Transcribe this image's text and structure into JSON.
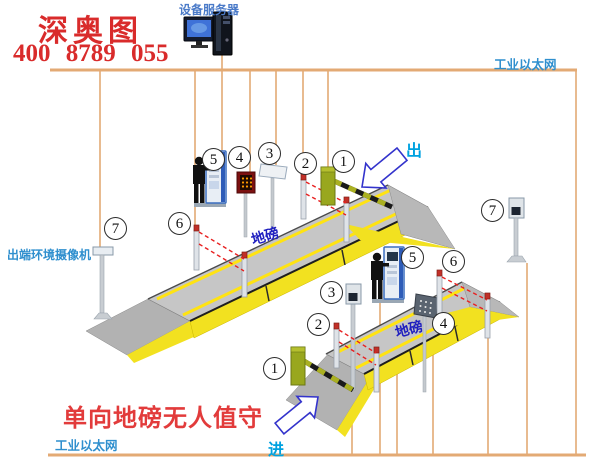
{
  "title": {
    "brand": "深奥图",
    "phone": "400 8789 055"
  },
  "network": {
    "server_label": "设备服务器",
    "ethernet_top": "工业以太网",
    "ethernet_bottom": "工业以太网"
  },
  "labels": {
    "exit_camera": "出端环境摄像机",
    "scale_top": "地磅",
    "scale_bottom": "地磅",
    "exit_flow": "出",
    "entry_flow": "进",
    "caption": "单向地磅无人值守"
  },
  "markers": [
    {
      "id": "exit-barrier-gate",
      "label": "1"
    },
    {
      "id": "exit-ir-sensor-front",
      "label": "2"
    },
    {
      "id": "exit-lcd-panel",
      "label": "3"
    },
    {
      "id": "exit-led-sign",
      "label": "4"
    },
    {
      "id": "exit-kiosk",
      "label": "5"
    },
    {
      "id": "exit-ir-sensor-rear",
      "label": "6"
    },
    {
      "id": "exit-env-camera",
      "label": "7"
    },
    {
      "id": "entry-kiosk",
      "label": "5"
    },
    {
      "id": "entry-ir-sensor-rear",
      "label": "6"
    },
    {
      "id": "entry-camera",
      "label": "3"
    },
    {
      "id": "entry-ir-sensor-front",
      "label": "2"
    },
    {
      "id": "entry-dot-display",
      "label": "4"
    },
    {
      "id": "entry-barrier-gate",
      "label": "1"
    },
    {
      "id": "entry-env-camera",
      "label": "7"
    }
  ],
  "colors": {
    "wire": "#e3aa74",
    "label_blue": "#2f8fce",
    "server_blue": "#4a7ac8",
    "brand_red": "#d92b2b",
    "caption_red": "#e23b3b",
    "scale_blue": "#1f1fbf",
    "flow_cyan": "#00a2e0",
    "deck_gray": "#c6c6c6",
    "wall_yellow": "#f2e120",
    "barrier_olive": "#99a71e",
    "beam_red": "#e82020"
  }
}
